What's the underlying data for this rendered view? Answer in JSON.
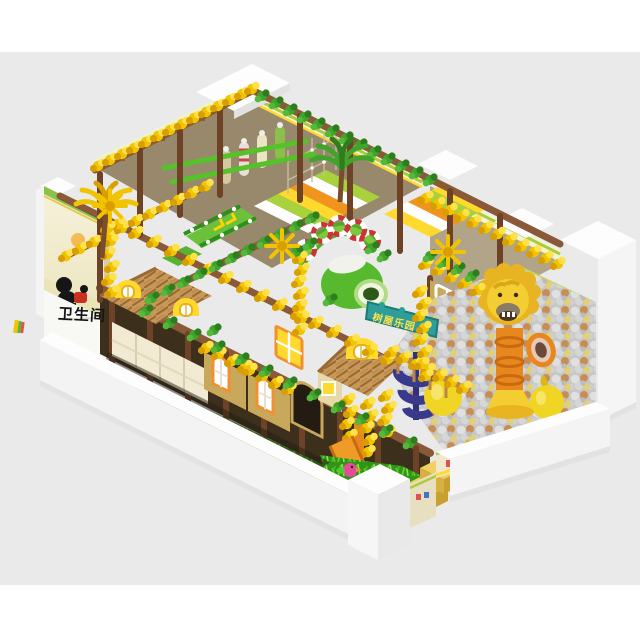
{
  "scene": {
    "description": "isometric 3D render of a jungle-themed indoor soft-play playground on a white base platform",
    "background": {
      "top_band": "#ffffff",
      "canvas": "#eaeaea",
      "bottom_band": "#ffffff"
    }
  },
  "labels": {
    "restroom": "卫生间",
    "treehouse_sign": "树屋乐园"
  },
  "palette": {
    "bg_gray": "#eaeaea",
    "wall_white": "#f6f6f6",
    "wall_shade": "#e2e2e2",
    "wood": "#8a5a38",
    "wood_dark": "#6e4226",
    "leaf": "#3fa32c",
    "leaf_dark": "#2e7d1e",
    "leaf_light": "#54b83a",
    "flower": "#f2c400",
    "flower_deep": "#d99e00",
    "flower_light": "#ffe14a",
    "rail_green": "#55c22a",
    "slide_green": "#6cc13a",
    "slide_dark": "#2f8f1e",
    "tube_green": "#57b92e",
    "lime": "#a8d23c",
    "grass": "#2f9418",
    "grass_light": "#5ecb2e",
    "khaki": "#c8a85a",
    "cream": "#f2ead2",
    "thatch": "#c89858",
    "thatch_dark": "#9a6a34",
    "roof_yellow": "#ffd92e",
    "orange": "#e8871e",
    "orange_deep": "#c96a10",
    "ball_bg": "#c6c6c6",
    "ball_silver": "#e0e0e0",
    "ball_tan": "#c98d52",
    "ball_yellow": "#e6cf6e",
    "pear": "#f0d525",
    "lion": "#f3cd32",
    "lion_mane": "#e8b422",
    "mural_cream": "#f3eed6",
    "navy": "#3a3a8c",
    "teal": "#2e9e9a",
    "sign_text": "#ffe14a",
    "black_ink": "#141414"
  },
  "elements": [
    {
      "name": "left-mural-wall",
      "detail": "cream wall art with black monkey figure and orange sun"
    },
    {
      "name": "restroom-floor-label",
      "detail": "black Chinese characters on white floor"
    },
    {
      "name": "flower-garlands",
      "detail": "yellow blossom vines wrapped on all top beams"
    },
    {
      "name": "leaf-vines",
      "detail": "green leaf vines on beams"
    },
    {
      "name": "wood-frame",
      "detail": "brown timber posts and beams, two storeys"
    },
    {
      "name": "green-slide-chevrons",
      "detail": "green slide with yellow arrows on upper deck"
    },
    {
      "name": "caterpillar-tube-slide",
      "detail": "green barrel slide with white/red life-ring arch"
    },
    {
      "name": "treehouse-sign",
      "detail": "teal banner with yellow Chinese lettering"
    },
    {
      "name": "thatch-roof-huts",
      "detail": "straw roofs with yellow dome dormer windows"
    },
    {
      "name": "ball-pit",
      "detail": "silver, tan and yellow balls"
    },
    {
      "name": "lion-head-tube-slide",
      "detail": "yellow lion head on orange tube with funnel"
    },
    {
      "name": "pear-punchbags",
      "detail": "two large yellow inflatable pears in ball pit"
    },
    {
      "name": "navy-spiral-slide",
      "detail": "dark blue spiral chute into ball pit"
    },
    {
      "name": "right-mural-wall",
      "detail": "pastel landscape with straw-hat child character"
    },
    {
      "name": "grass-play-strip",
      "detail": "green shag turf with toy birds and yellow steps"
    },
    {
      "name": "white-perimeter-wall",
      "detail": "low white padded walls with cartoon trim panels and entrance gap"
    }
  ]
}
